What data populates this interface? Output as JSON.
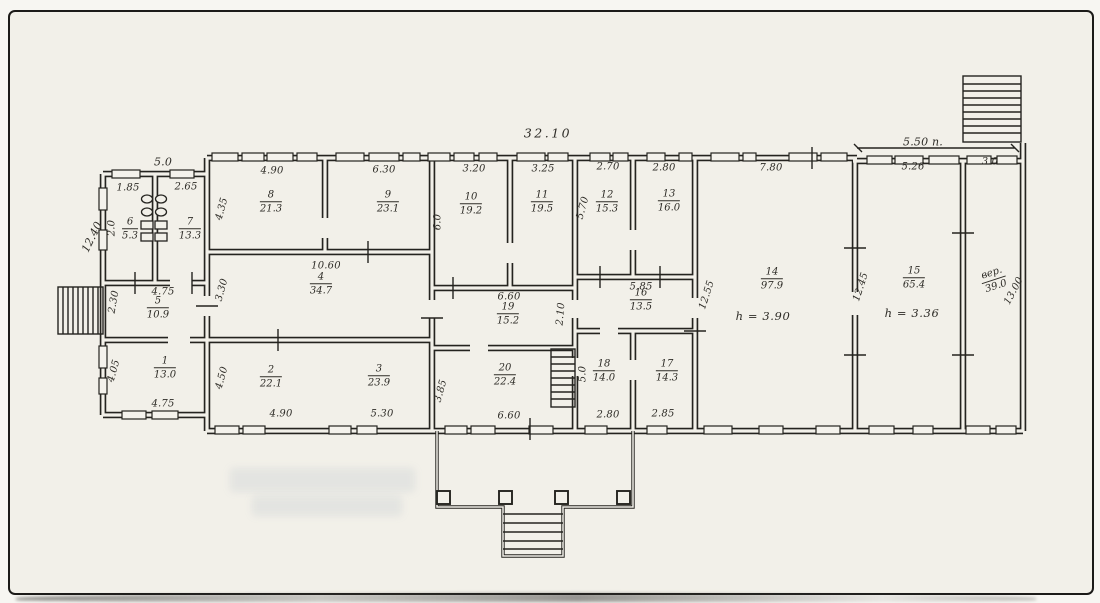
{
  "colors": {
    "ink": "#2e2c27",
    "paper": "#f2f0e9",
    "frame": "#1c1b19"
  },
  "dims": {
    "building_top": "32.10",
    "annex_top": "5.0",
    "right_top": "5.50 п.",
    "w185": "1.85",
    "w265": "2.65",
    "w490_top": "4.90",
    "w630": "6.30",
    "w320": "3.20",
    "w325": "3.25",
    "w270": "2.70",
    "w280_top": "2.80",
    "w780": "7.80",
    "w526": "5.26",
    "w30": "3.0",
    "w1060": "10.60",
    "w660_mid": "6.60",
    "w585": "5.85",
    "w475_top": "4.75",
    "w475_bottom": "4.75",
    "w490_bottom": "4.90",
    "w530": "5.30",
    "w660_bottom": "6.60",
    "w280_bottom": "2.80",
    "w285": "2.85",
    "h1240": "12.40",
    "h20": "2.0",
    "h230": "2.30",
    "h405": "4.05",
    "h435": "4.35",
    "h330": "3.30",
    "h450": "4.50",
    "h60": "6.0",
    "h570": "5.70",
    "h210": "2.10",
    "h385": "3.85",
    "h50": "5.0",
    "h1255": "12.55",
    "h1245": "12.45",
    "h1300": "13.00"
  },
  "rooms": {
    "r1": {
      "num": "1",
      "area": "13.0"
    },
    "r2": {
      "num": "2",
      "area": "22.1"
    },
    "r3": {
      "num": "3",
      "area": "23.9"
    },
    "r4": {
      "num": "4",
      "area": "34.7"
    },
    "r5": {
      "num": "5",
      "area": "10.9"
    },
    "r6": {
      "num": "6",
      "area": "5.3"
    },
    "r7": {
      "num": "7",
      "area": "13.3"
    },
    "r8": {
      "num": "8",
      "area": "21.3"
    },
    "r9": {
      "num": "9",
      "area": "23.1"
    },
    "r10": {
      "num": "10",
      "area": "19.2"
    },
    "r11": {
      "num": "11",
      "area": "19.5"
    },
    "r12": {
      "num": "12",
      "area": "15.3"
    },
    "r13": {
      "num": "13",
      "area": "16.0"
    },
    "r14": {
      "num": "14",
      "area": "97.9",
      "height": "h = 3.90"
    },
    "r15": {
      "num": "15",
      "area": "65.4",
      "height": "h = 3.36"
    },
    "r16": {
      "num": "16",
      "area": "13.5"
    },
    "r17": {
      "num": "17",
      "area": "14.3"
    },
    "r18": {
      "num": "18",
      "area": "14.0"
    },
    "r19": {
      "num": "19",
      "area": "15.2"
    },
    "r20": {
      "num": "20",
      "area": "22.4"
    },
    "veranda": {
      "num": "вер.",
      "area": "39.0"
    }
  }
}
